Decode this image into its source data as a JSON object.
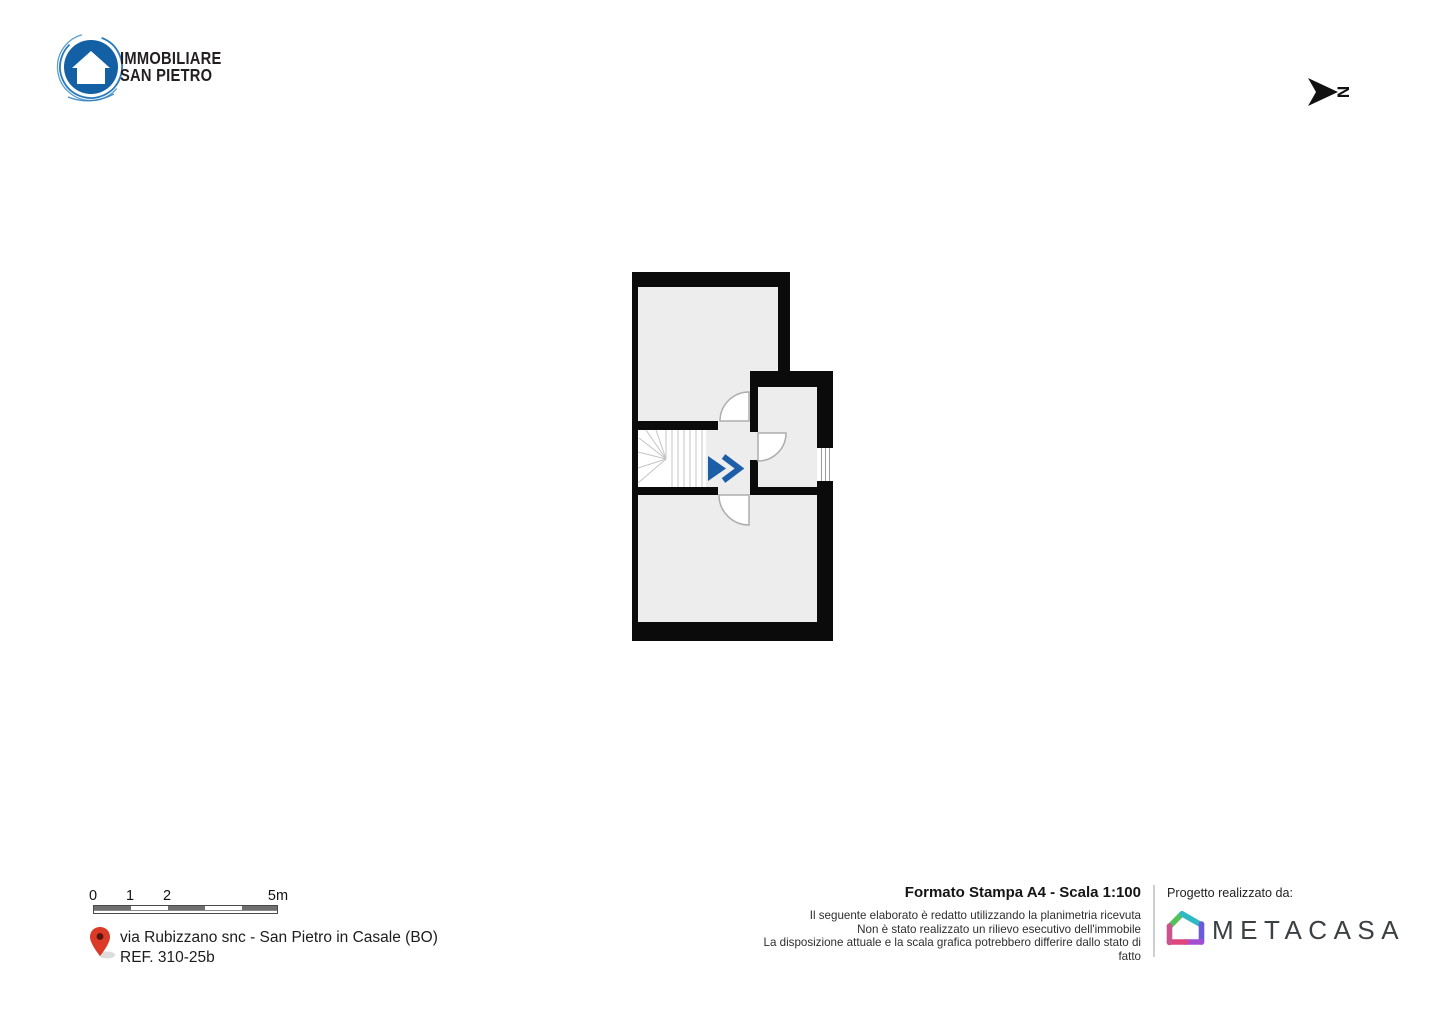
{
  "brand": {
    "line1": "IMMOBILIARE",
    "line2": "SAN PIETRO"
  },
  "north": {
    "label": "N"
  },
  "scalebar": {
    "tick0": "0",
    "tick1": "1",
    "tick2": "2",
    "tick3": "5m"
  },
  "address": {
    "line1": "via Rubizzano snc - San Pietro in Casale (BO)",
    "line2": "REF. 310-25b"
  },
  "print_info": {
    "title": "Formato Stampa A4 - Scala 1:100",
    "disclaimer": [
      "Il seguente elaborato è redatto utilizzando la planimetria ricevuta",
      "Non è stato realizzato un rilievo esecutivo dell'immobile",
      "La disposizione attuale e la scala grafica potrebbero differire dallo stato di fatto"
    ]
  },
  "credits": {
    "label": "Progetto realizzato da:",
    "brand": "METACASA"
  },
  "colors": {
    "accent_blue": "#1c5fa8",
    "logo_blue": "#1360a4",
    "pin_red": "#da3a27",
    "wall": "#0b0b0b",
    "room_fill": "#ededed"
  }
}
